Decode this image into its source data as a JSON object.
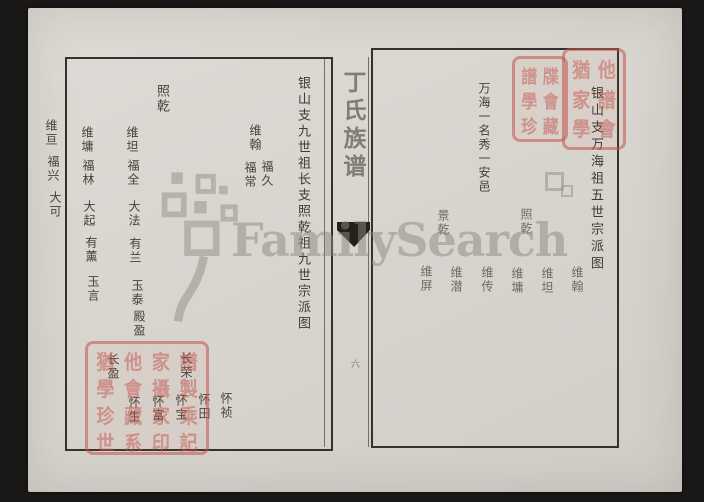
{
  "watermark": {
    "brand_text": "FamilySearch"
  },
  "spine": {
    "book_title": "丁氏族谱",
    "page_number": "六"
  },
  "left_page": {
    "title": "银山支九世祖长支照乾祖九世宗派图",
    "ancestor": "照乾",
    "branch_weihan": {
      "father": "维翰",
      "sons": [
        "福久",
        "福常"
      ]
    },
    "column_weitan": [
      "维坦",
      "福全",
      "大法",
      "有兰",
      "玉泰",
      "殿盈"
    ],
    "column_weiyong": [
      "维墉",
      "福林",
      "大起",
      "有薰",
      "玉言"
    ],
    "edge_column": [
      "维亘",
      "福兴",
      "大可"
    ],
    "lower_generation": {
      "fathers": [
        "长荣",
        "长盈"
      ],
      "sons": [
        "怀祯",
        "怀田",
        "怀宝",
        "怀富",
        "怀生"
      ]
    }
  },
  "right_page": {
    "title": "银山支万海祖五世宗派图",
    "ancestor_line": "万海一名秀一安邑",
    "fathers": [
      "照乾",
      "景乾"
    ],
    "sons": [
      "维翰",
      "维坦",
      "维墉",
      "维传",
      "维潜",
      "维屏"
    ]
  },
  "seals": {
    "color": "#c1564e",
    "top_small_glyphs": "譜牒學會珍藏",
    "top_large_glyphs": "猶他家譜學會",
    "bottom_glyphs": "猶他家譜學會攝製珍藏家乘世系印記"
  }
}
